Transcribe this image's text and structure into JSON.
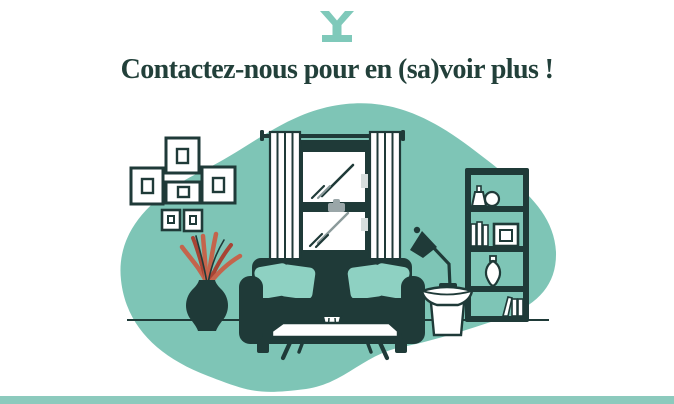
{
  "header": {
    "logo": {
      "name": "brand-y-icon",
      "color": "#7fc9ba"
    },
    "heading": "Contactez-nous pour en (sa)voir plus !"
  },
  "palette": {
    "ink": "#1f3a38",
    "heading_ink": "#22403a",
    "teal": "#7ec5b6",
    "teal_light": "#8ed1c2",
    "teal_bar": "#8ccabd",
    "coral": "#c4644c",
    "coral_dark": "#a84434",
    "gray": "#9aa6a8",
    "gray_light": "#d7dedd",
    "glass_line": "#8b9a9b",
    "white": "#ffffff"
  },
  "illustration": {
    "name": "living-room-illustration",
    "elements": [
      "background-blob",
      "floor-line",
      "wall-frames",
      "window-with-curtains",
      "bookshelf",
      "plant-in-vase",
      "sofa-with-pillows",
      "desk-lamp",
      "side-table",
      "coffee-table"
    ]
  },
  "footer": {
    "bar_color": "#8ccabd"
  }
}
